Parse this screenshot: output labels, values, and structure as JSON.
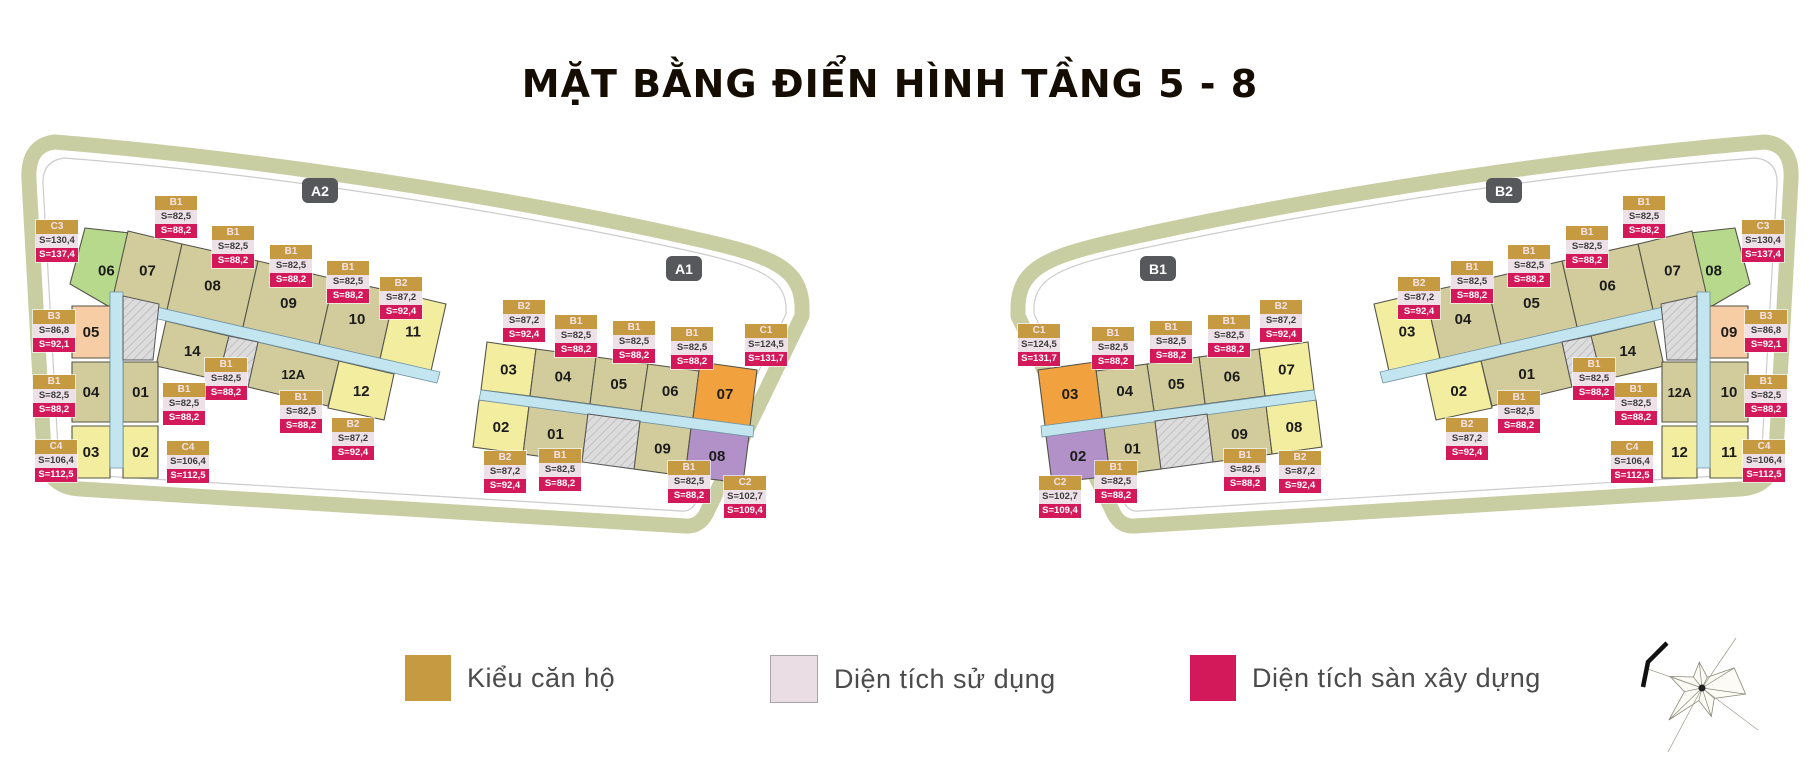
{
  "title": "MẶT BẰNG ĐIỂN HÌNH TẦNG 5 - 8",
  "unit_types": {
    "B1": {
      "usable": "S=82,5",
      "built": "S=88,2"
    },
    "B2": {
      "usable": "S=87,2",
      "built": "S=92,4"
    },
    "B3": {
      "usable": "S=86,8",
      "built": "S=92,1"
    },
    "C1": {
      "usable": "S=124,5",
      "built": "S=131,7"
    },
    "C2": {
      "usable": "S=102,7",
      "built": "S=109,4"
    },
    "C3": {
      "usable": "S=130,4",
      "built": "S=137,4"
    },
    "C4": {
      "usable": "S=106,4",
      "built": "S=112,5"
    }
  },
  "colors": {
    "khaki": "#D2CC9C",
    "yellow": "#F3EDA0",
    "green": "#B6D98B",
    "peach": "#F6CDA4",
    "orange": "#F1A13E",
    "purple": "#B191C8",
    "corridor": "#C3E5F0",
    "core": "#DCDCDC",
    "site": "#C8CDA2",
    "gold": "#C59A40",
    "pink": "#EADDE4",
    "crimson": "#D4195B",
    "badge": "#57585C"
  },
  "plan": {
    "badges": [
      {
        "label": "A2"
      },
      {
        "label": "A1"
      },
      {
        "label": "B1"
      },
      {
        "label": "B2"
      }
    ],
    "sections": [
      {
        "building": "left",
        "badge": "A2",
        "wing": "A2",
        "mirrored": false,
        "units": {
          "t1": {
            "no": "06",
            "c": "green"
          },
          "t2": {
            "no": "07",
            "c": "khaki"
          },
          "t3": {
            "no": "08",
            "c": "khaki"
          },
          "t4": {
            "no": "09",
            "c": "khaki"
          },
          "t5": {
            "no": "10",
            "c": "khaki"
          },
          "t6": {
            "no": "11",
            "c": "yellow"
          },
          "r2a": {
            "no": "14",
            "c": "khaki"
          },
          "r2b": {
            "no": "12A",
            "c": "khaki"
          },
          "r2c": {
            "no": "12",
            "c": "yellow"
          },
          "colTop": {
            "no": "05",
            "c": "peach"
          },
          "colMidL": {
            "no": "04",
            "c": "khaki"
          },
          "colMidR": {
            "no": "01",
            "c": "khaki"
          },
          "colBotL": {
            "no": "03",
            "c": "yellow"
          },
          "colBotR": {
            "no": "02",
            "c": "yellow"
          }
        }
      },
      {
        "building": "left",
        "badge": "A1",
        "wing": "A1",
        "mirrored": false,
        "units": {
          "t1": {
            "no": "03",
            "c": "yellow"
          },
          "t2": {
            "no": "04",
            "c": "khaki"
          },
          "t3": {
            "no": "05",
            "c": "khaki"
          },
          "t4": {
            "no": "06",
            "c": "khaki"
          },
          "t5": {
            "no": "07",
            "c": "orange"
          },
          "b1": {
            "no": "02",
            "c": "yellow"
          },
          "b2": {
            "no": "01",
            "c": "khaki"
          },
          "b3": {
            "no": "09",
            "c": "khaki"
          },
          "b4": {
            "no": "08",
            "c": "purple"
          }
        }
      },
      {
        "building": "right",
        "badge": "B1",
        "wing": "A1",
        "mirrored": true,
        "units": {
          "t1": {
            "no": "07",
            "c": "yellow"
          },
          "t2": {
            "no": "06",
            "c": "khaki"
          },
          "t3": {
            "no": "05",
            "c": "khaki"
          },
          "t4": {
            "no": "04",
            "c": "khaki"
          },
          "t5": {
            "no": "03",
            "c": "orange"
          },
          "b1": {
            "no": "08",
            "c": "yellow"
          },
          "b2": {
            "no": "09",
            "c": "khaki"
          },
          "b3": {
            "no": "01",
            "c": "khaki"
          },
          "b4": {
            "no": "02",
            "c": "purple"
          }
        }
      },
      {
        "building": "right",
        "badge": "B2",
        "wing": "A2",
        "mirrored": true,
        "units": {
          "t1": {
            "no": "08",
            "c": "green"
          },
          "t2": {
            "no": "07",
            "c": "khaki"
          },
          "t3": {
            "no": "06",
            "c": "khaki"
          },
          "t4": {
            "no": "05",
            "c": "khaki"
          },
          "t5": {
            "no": "04",
            "c": "khaki"
          },
          "t6": {
            "no": "03",
            "c": "yellow"
          },
          "r2a": {
            "no": "14",
            "c": "khaki"
          },
          "r2b": {
            "no": "01",
            "c": "khaki"
          },
          "r2c": {
            "no": "02",
            "c": "yellow"
          },
          "colTop": {
            "no": "09",
            "c": "peach"
          },
          "colMidL": {
            "no": "10",
            "c": "khaki"
          },
          "colMidR": {
            "no": "12A",
            "c": "khaki"
          },
          "colBotL": {
            "no": "11",
            "c": "yellow"
          },
          "colBotR": {
            "no": "12",
            "c": "yellow"
          }
        }
      }
    ],
    "labels": {
      "left": [
        "C3",
        "B3",
        "B1",
        "C4",
        "B1",
        "B1",
        "B1",
        "B1",
        "B2",
        "B1",
        "B1",
        "B1",
        "B2",
        "C4",
        "B2",
        "B1",
        "B1",
        "B1",
        "C1",
        "B2",
        "B1",
        "B1",
        "C2"
      ],
      "right": [
        "C3",
        "B3",
        "B1",
        "C4",
        "B1",
        "B1",
        "B1",
        "B1",
        "B2",
        "B1",
        "B1",
        "B1",
        "B2",
        "C4",
        "B2",
        "B1",
        "B1",
        "B1",
        "C1",
        "B2",
        "B1",
        "B1",
        "C2"
      ]
    }
  },
  "legend": {
    "items": [
      {
        "label": "Kiểu căn hộ",
        "color": "#C59A40"
      },
      {
        "label": "Diện tích sử dụng",
        "color": "#EADDE4"
      },
      {
        "label": "Diện tích sàn xây dựng",
        "color": "#D4195B"
      }
    ]
  },
  "icons": {
    "compass": "compass-rose-north-arrow"
  }
}
